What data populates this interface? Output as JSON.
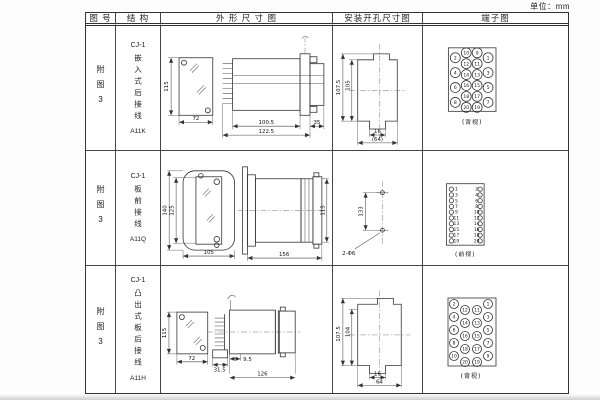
{
  "unit_label": "单位：mm",
  "header": {
    "fig_no": "图 号",
    "structure": "结 构",
    "outline": "外 形 尺 寸 图",
    "mounting": "安装开孔尺寸图",
    "terminal": "端子图"
  },
  "rows": [
    {
      "fig_no": "附图3",
      "model": "CJ-1",
      "desc": "嵌入式后接线",
      "code": "A11K",
      "outline": {
        "front_h": "115",
        "front_w": "72",
        "body_len": "100.5",
        "total_len": "122.5",
        "flange": "35"
      },
      "mounting": {
        "outer_h": "107.5",
        "inner_h": "105",
        "slot_w": "16",
        "total_w": "(64)"
      },
      "terminal_caption": "(背视)"
    },
    {
      "fig_no": "附图3",
      "model": "CJ-1",
      "desc": "板前接线",
      "code": "A11Q",
      "outline": {
        "outer_h": "140",
        "inner_h": "125",
        "width": "105",
        "length": "156",
        "side_h": "115"
      },
      "mounting": {
        "pitch": "133",
        "holes": "2-Φ6"
      },
      "terminal_caption": "(前视)"
    },
    {
      "fig_no": "附图3",
      "model": "CJ-1",
      "desc": "凸出式板后接线",
      "code": "A11H",
      "outline": {
        "front_h": "115",
        "front_w": "72",
        "stub": "9.5",
        "tab": "31.5",
        "length": "126"
      },
      "mounting": {
        "outer_h": "107.5",
        "inner_h": "104",
        "slot_w": "16",
        "total_w": "64"
      },
      "terminal_caption": "(背视)"
    }
  ],
  "terminals": {
    "row1": {
      "view": "rear",
      "r": 5,
      "fs": 4.6,
      "columns": [
        {
          "x": 32,
          "y0": 32,
          "dy": 15,
          "nums": [
            "2",
            "4",
            "6",
            "8"
          ]
        },
        {
          "x": 43,
          "y0": 27,
          "dy": 11,
          "nums": [
            "10",
            "12",
            "14",
            "16",
            "18",
            "20"
          ]
        },
        {
          "x": 54,
          "y0": 27,
          "dy": 11,
          "nums": [
            "9",
            "11",
            "13",
            "15",
            "17",
            "19"
          ]
        },
        {
          "x": 65,
          "y0": 32,
          "dy": 15,
          "nums": [
            "1",
            "3",
            "5",
            "7"
          ]
        }
      ]
    },
    "row2": {
      "view": "front",
      "r": 2.2,
      "fs": 4.4,
      "y0": 38.5,
      "dy": 5.8,
      "left_nums": [
        "1",
        "3",
        "5",
        "7",
        "9",
        "11",
        "13",
        "15",
        "17",
        "19"
      ],
      "right_nums": [
        "2",
        "4",
        "6",
        "8",
        "10",
        "12",
        "14",
        "16",
        "18",
        "20"
      ]
    },
    "row3": {
      "view": "rear",
      "r": 4.5,
      "fs": 4.4,
      "columns": [
        {
          "x": 31,
          "y0": 38,
          "dy": 13,
          "nums": [
            "2",
            "4",
            "6",
            "8",
            "10"
          ]
        },
        {
          "x": 42,
          "y0": 44,
          "dy": 13,
          "nums": [
            "12",
            "14",
            "16",
            "18",
            "20"
          ]
        },
        {
          "x": 54,
          "y0": 44,
          "dy": 13,
          "nums": [
            "11",
            "13",
            "15",
            "17",
            "19"
          ]
        },
        {
          "x": 65,
          "y0": 38,
          "dy": 13,
          "nums": [
            "1",
            "3",
            "5",
            "7",
            "9"
          ]
        }
      ]
    }
  }
}
